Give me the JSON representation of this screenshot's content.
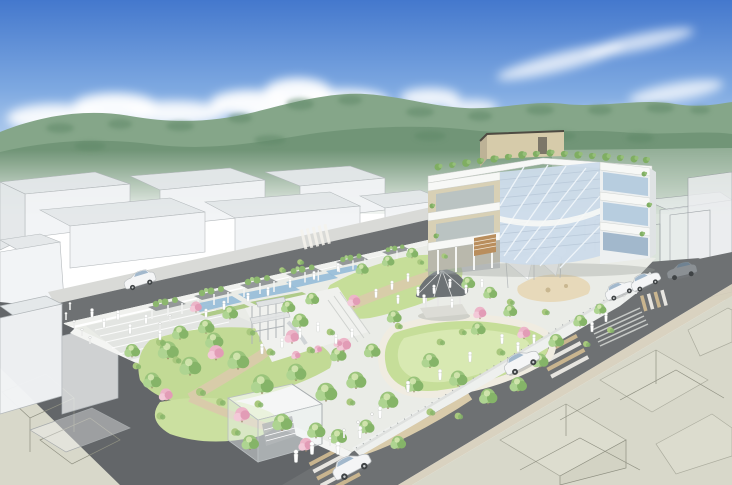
{
  "palette": {
    "sky_top": "#4478cd",
    "sky_mid": "#7ea9e1",
    "sky_low": "#bad3f0",
    "sky_horizon": "#eaf3fb",
    "cloud": "#ffffff",
    "hill_back": "#85a689",
    "hill_front": "#6f9476",
    "hill_dark": "#5d8766",
    "hill_haze": "#b7c9ba",
    "massing_fill": "#f2f4f6",
    "massing_face": "#e4e8ea",
    "massing_line": "#b2b7ba",
    "road": "#6e7173",
    "road_dark": "#636669",
    "sidewalk": "#d9dad7",
    "stripe_tan": "#d3bc92",
    "stripe_white": "#f4f2ec",
    "beige": "#d8d8ca",
    "beige_block": "#e0e0d2",
    "beige_line": "#8f9082",
    "paving": "#eaece7",
    "plaza": "#f0f1ee",
    "lawn": "#c6de99",
    "lawn_light": "#dcebb8",
    "path_tan": "#d9cbaa",
    "path_light": "#f0ece1",
    "water": "#96bcd8",
    "planting": "#a9c87e",
    "sand": "#e7d9ba",
    "pergola_top": "#8e9294",
    "vine": "#8cb76e",
    "slab": "#f7f8f6",
    "wall_beige": "#d8d0b5",
    "pent": "#d6cbaa",
    "pent_side": "#bdb296",
    "pent_cap": "#4e4b42",
    "glass": "#ccdbea",
    "glass_dark": "#a2b8cc",
    "glass_line": "#eef4f9",
    "louver": "#b9c9d9",
    "gazebo_roof": "#6d7275",
    "wood": "#b98e5d",
    "white_struct": "#fbfcfd",
    "tree_green": "#9ac47b",
    "tree_light": "#aed491",
    "tree_dark": "#85b468",
    "tree_pink": "#ecb5c8",
    "tree_pink_dark": "#e29cb6",
    "trunk": "#9b8568",
    "people": "#ffffff",
    "car_white": "#f4f5f6",
    "car_gray": "#8b9094",
    "wheel": "#3f4345",
    "shadow": "#7a7e80"
  },
  "scene": {
    "layers": [
      {
        "id": "pergolas-layer",
        "sym": "pergola",
        "items": [
          [
            148,
            307,
            1
          ],
          [
            194,
            296,
            1
          ],
          [
            240,
            285,
            1
          ],
          [
            286,
            274,
            0.95
          ],
          [
            336,
            262,
            0.85
          ],
          [
            382,
            252,
            0.75
          ]
        ]
      },
      {
        "id": "trees-green-layer",
        "sym": "tree-green",
        "items": [
          [
            168,
            352,
            1.2
          ],
          [
            190,
            368,
            1.25
          ],
          [
            214,
            342,
            1.05
          ],
          [
            238,
            362,
            1.25
          ],
          [
            262,
            386,
            1.3
          ],
          [
            296,
            374,
            1.15
          ],
          [
            326,
            394,
            1.25
          ],
          [
            356,
            382,
            1.15
          ],
          [
            388,
            402,
            1.15
          ],
          [
            414,
            386,
            1.05
          ],
          [
            300,
            322,
            0.95
          ],
          [
            230,
            314,
            0.9
          ],
          [
            206,
            328,
            0.95
          ],
          [
            430,
            362,
            1
          ],
          [
            458,
            380,
            1.05
          ],
          [
            488,
            398,
            1.05
          ],
          [
            518,
            386,
            1
          ],
          [
            540,
            362,
            0.95
          ],
          [
            556,
            342,
            0.9
          ],
          [
            180,
            334,
            0.95
          ],
          [
            152,
            382,
            1.05
          ],
          [
            282,
            424,
            1.15
          ],
          [
            316,
            432,
            1.05
          ],
          [
            250,
            444,
            1
          ],
          [
            372,
            352,
            0.95
          ],
          [
            338,
            356,
            0.95
          ],
          [
            394,
            318,
            0.85
          ],
          [
            362,
            270,
            0.75
          ],
          [
            388,
            262,
            0.72
          ],
          [
            412,
            254,
            0.7
          ],
          [
            338,
            438,
            1
          ],
          [
            366,
            428,
            0.95
          ],
          [
            398,
            444,
            0.9
          ],
          [
            580,
            322,
            0.8
          ],
          [
            600,
            310,
            0.72
          ],
          [
            468,
            284,
            0.8
          ],
          [
            490,
            294,
            0.8
          ],
          [
            132,
            352,
            0.9
          ],
          [
            478,
            330,
            0.85
          ],
          [
            510,
            312,
            0.8
          ],
          [
            312,
            300,
            0.8
          ],
          [
            288,
            308,
            0.82
          ]
        ]
      },
      {
        "id": "trees-pink-layer",
        "sym": "tree-pink",
        "items": [
          [
            216,
            354,
            1.05
          ],
          [
            292,
            338,
            0.95
          ],
          [
            344,
            346,
            0.95
          ],
          [
            480,
            314,
            0.85
          ],
          [
            524,
            334,
            0.85
          ],
          [
            242,
            416,
            1.05
          ],
          [
            196,
            308,
            0.78
          ],
          [
            306,
            446,
            0.95
          ],
          [
            354,
            302,
            0.85
          ],
          [
            166,
            396,
            0.9
          ],
          [
            296,
            356,
            0.6
          ],
          [
            318,
            350,
            0.55
          ],
          [
            338,
            344,
            0.55
          ]
        ]
      },
      {
        "id": "bushes-layer",
        "sym": "bush",
        "items": [
          [
            160,
            342,
            1
          ],
          [
            176,
            360,
            0.9
          ],
          [
            250,
            332,
            0.9
          ],
          [
            270,
            352,
            0.9
          ],
          [
            310,
            350,
            0.85
          ],
          [
            330,
            332,
            0.85
          ],
          [
            398,
            326,
            0.8
          ],
          [
            440,
            342,
            0.85
          ],
          [
            462,
            332,
            0.8
          ],
          [
            500,
            352,
            0.9
          ],
          [
            520,
            362,
            0.85
          ],
          [
            200,
            392,
            1
          ],
          [
            220,
            402,
            0.95
          ],
          [
            258,
            404,
            0.9
          ],
          [
            350,
            402,
            0.9
          ],
          [
            430,
            412,
            0.9
          ],
          [
            458,
            416,
            0.85
          ],
          [
            235,
            432,
            0.95
          ],
          [
            160,
            416,
            0.9
          ],
          [
            136,
            366,
            0.85
          ],
          [
            510,
            302,
            0.8
          ],
          [
            545,
            312,
            0.8
          ],
          [
            420,
            262,
            0.7
          ],
          [
            444,
            256,
            0.65
          ],
          [
            300,
            262,
            0.7
          ],
          [
            282,
            270,
            0.7
          ],
          [
            610,
            330,
            0.75
          ],
          [
            586,
            344,
            0.75
          ]
        ]
      },
      {
        "id": "roof-plants-layer",
        "sym": "tree-roof",
        "items": [
          [
            438,
            167,
            1
          ],
          [
            452,
            165,
            0.85
          ],
          [
            466,
            163,
            1.1
          ],
          [
            480,
            161,
            0.9
          ],
          [
            494,
            159,
            1.05
          ],
          [
            508,
            157,
            0.9
          ],
          [
            522,
            155,
            1.1
          ],
          [
            536,
            154,
            0.9
          ],
          [
            550,
            153,
            1
          ],
          [
            564,
            154,
            0.9
          ],
          [
            578,
            155,
            1.05
          ],
          [
            592,
            156,
            0.9
          ],
          [
            606,
            157,
            1.1
          ],
          [
            620,
            158,
            0.9
          ],
          [
            634,
            159,
            1
          ],
          [
            646,
            160,
            0.9
          ],
          [
            644,
            174,
            0.7
          ],
          [
            649,
            205,
            0.7
          ],
          [
            642,
            234,
            0.7
          ],
          [
            432,
            206,
            0.7
          ],
          [
            436,
            236,
            0.7
          ]
        ]
      },
      {
        "id": "people-layer",
        "sym": "person",
        "items": [
          [
            92,
            316,
            1
          ],
          [
            104,
            326,
            1.05
          ],
          [
            118,
            318,
            1
          ],
          [
            130,
            332,
            1.05
          ],
          [
            146,
            322,
            1
          ],
          [
            160,
            338,
            1.05
          ],
          [
            206,
            316,
            0.95
          ],
          [
            224,
            308,
            0.95
          ],
          [
            248,
            300,
            0.95
          ],
          [
            268,
            294,
            0.95
          ],
          [
            290,
            286,
            0.9
          ],
          [
            314,
            278,
            0.9
          ],
          [
            338,
            270,
            0.9
          ],
          [
            300,
            336,
            1.05
          ],
          [
            318,
            330,
            1.05
          ],
          [
            336,
            342,
            1.05
          ],
          [
            282,
            346,
            1.05
          ],
          [
            262,
            352,
            1.1
          ],
          [
            352,
            336,
            1.05
          ],
          [
            376,
            296,
            0.95
          ],
          [
            392,
            288,
            0.95
          ],
          [
            408,
            280,
            0.9
          ],
          [
            398,
            302,
            0.95
          ],
          [
            418,
            294,
            0.95
          ],
          [
            434,
            292,
            0.95
          ],
          [
            450,
            286,
            0.95
          ],
          [
            466,
            292,
            0.95
          ],
          [
            482,
            286,
            0.95
          ],
          [
            424,
            302,
            1
          ],
          [
            502,
            342,
            1.05
          ],
          [
            518,
            350,
            1.05
          ],
          [
            534,
            342,
            1
          ],
          [
            470,
            360,
            1.1
          ],
          [
            440,
            378,
            1.15
          ],
          [
            408,
            390,
            1.2
          ],
          [
            380,
            416,
            1.25
          ],
          [
            360,
            436,
            1.3
          ],
          [
            338,
            452,
            1.35
          ],
          [
            592,
            330,
            1.05
          ],
          [
            606,
            320,
            1
          ],
          [
            452,
            306,
            1
          ],
          [
            296,
            460,
            1.35
          ],
          [
            312,
            452,
            1.35
          ]
        ]
      },
      {
        "id": "bollards-layer",
        "sym": "bollard",
        "items": [
          [
            66,
            320,
            1
          ],
          [
            74,
            328,
            1
          ],
          [
            82,
            336,
            1
          ],
          [
            90,
            344,
            1
          ],
          [
            70,
            310,
            1
          ],
          [
            330,
            446,
            1.2
          ],
          [
            344,
            438,
            1.2
          ],
          [
            358,
            430,
            1.2
          ],
          [
            372,
            422,
            1.2
          ],
          [
            624,
            302,
            1
          ],
          [
            636,
            294,
            1
          ],
          [
            160,
            330,
            1
          ],
          [
            170,
            322,
            1
          ]
        ]
      },
      {
        "id": "cars-layer",
        "sym": "car",
        "items": [
          {
            "sym": "car",
            "x": 140,
            "y": 281,
            "s": 1.0,
            "r": -17
          },
          {
            "sym": "car",
            "x": 522,
            "y": 363,
            "s": 1.15,
            "r": 28,
            "f": 1
          },
          {
            "sym": "car",
            "x": 352,
            "y": 467,
            "s": 1.25,
            "r": 28,
            "f": 1
          },
          {
            "sym": "car",
            "x": 620,
            "y": 291,
            "s": 0.95,
            "r": 25,
            "f": 1
          },
          {
            "sym": "car",
            "x": 646,
            "y": 282,
            "s": 0.95,
            "r": 25,
            "f": 1
          },
          {
            "sym": "car-gray",
            "x": 682,
            "y": 272,
            "s": 0.95,
            "r": -13
          }
        ]
      }
    ]
  }
}
